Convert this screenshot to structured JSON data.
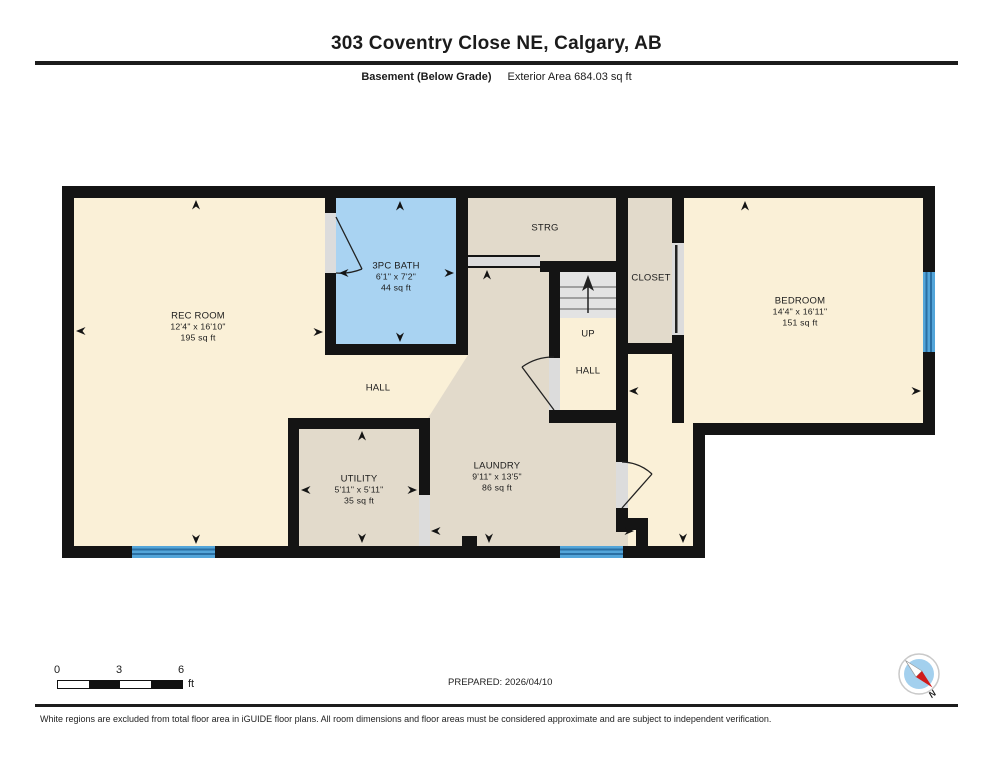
{
  "header": {
    "title": "303 Coventry Close NE, Calgary, AB",
    "floor_label": "Basement (Below Grade)",
    "area_label": "Exterior Area 684.03 sq ft"
  },
  "rooms": {
    "rec_room": {
      "name": "REC ROOM",
      "dims": "12'4\" x 16'10\"",
      "area": "195 sq ft"
    },
    "bath": {
      "name": "3PC BATH",
      "dims": "6'1\" x 7'2\"",
      "area": "44 sq ft"
    },
    "strg": {
      "name": "STRG"
    },
    "closet": {
      "name": "CLOSET"
    },
    "bedroom": {
      "name": "BEDROOM",
      "dims": "14'4\" x 16'11\"",
      "area": "151 sq ft"
    },
    "up": {
      "name": "UP"
    },
    "hall_stair": {
      "name": "HALL"
    },
    "hall_main": {
      "name": "HALL"
    },
    "utility": {
      "name": "UTILITY",
      "dims": "5'11\" x 5'11\"",
      "area": "35 sq ft"
    },
    "laundry": {
      "name": "LAUNDRY",
      "dims": "9'11\" x 13'5\"",
      "area": "86 sq ft"
    }
  },
  "footer": {
    "scale": {
      "ticks": [
        "0",
        "3",
        "6"
      ],
      "unit": "ft"
    },
    "prepared": "PREPARED: 2026/04/10",
    "disclaimer": "White regions are excluded from total floor area in iGUIDE floor plans. All room dimensions and floor areas must be considered approximate and are subject to independent verification."
  },
  "compass": {
    "north_label": "N"
  },
  "colors": {
    "wall": "#141414",
    "room_cream": "#FAF0D7",
    "room_tan": "#E2DACB",
    "bath_blue": "#A9D3F2",
    "window_blue": "#53A5D9",
    "window_line": "#2A6FA3",
    "stairs_gray": "#E3E3E3",
    "opening_gray": "#DCDCDC",
    "compass_red": "#CF1B1B",
    "compass_blue": "#A3D0EE"
  }
}
